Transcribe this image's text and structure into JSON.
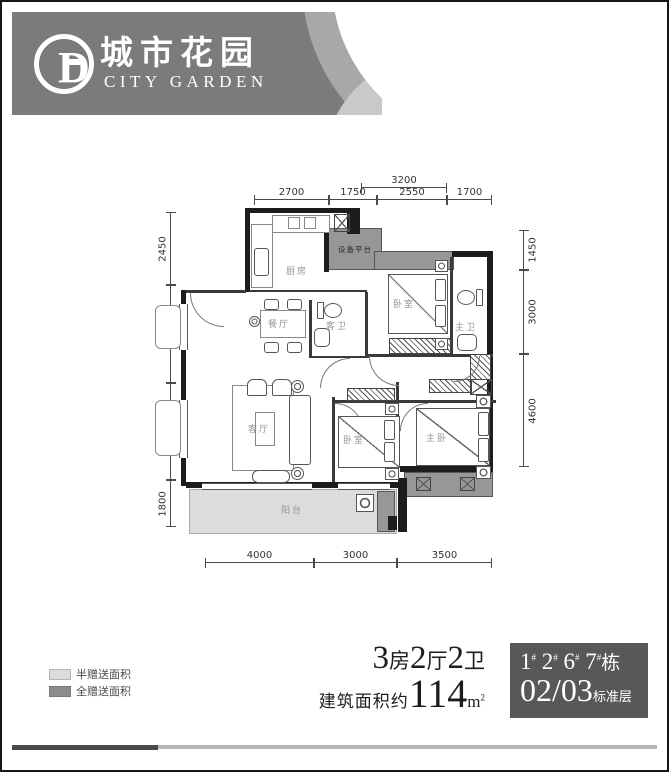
{
  "logo": {
    "letter_d": "D",
    "brand_cn": "城市花园",
    "brand_en": "CITY GARDEN"
  },
  "plan": {
    "rooms": {
      "kitchen": "厨房",
      "equipment": "设备平台",
      "bedroom_top": "卧室",
      "master_bath": "主卫",
      "dining": "餐厅",
      "guest_bath": "客卫",
      "living": "客厅",
      "bedroom_mid": "卧室",
      "master_bedroom": "主卧",
      "balcony": "阳台"
    },
    "dims": {
      "top_overall": "3200",
      "top": [
        "2700",
        "1750",
        "2550",
        "1700"
      ],
      "left": [
        "2450",
        "3800",
        "3300",
        "1800"
      ],
      "right": [
        "1450",
        "3000",
        "4600"
      ],
      "bottom": [
        "4000",
        "3000",
        "3500"
      ]
    }
  },
  "legend": {
    "items": [
      {
        "label": "半赠送面积",
        "color": "#dcdcde"
      },
      {
        "label": "全赠送面积",
        "color": "#8b8b8e"
      }
    ]
  },
  "summary": {
    "layout_digits": [
      "3",
      "2",
      "2"
    ],
    "layout_units": [
      "房",
      "厅",
      "卫"
    ],
    "area_prefix": "建筑面积约",
    "area_value": "114",
    "area_unit": "m",
    "area_sup": "2"
  },
  "badge": {
    "nums": [
      "1",
      "2",
      "6",
      "7"
    ],
    "hash": "#",
    "building_suffix": "栋",
    "floor": "02/03",
    "floor_suffix": "标准层"
  },
  "colors": {
    "banner": "#7b7b7e",
    "banner_light": "#a8a8ab",
    "banner_lighter": "#c9c9cc",
    "half_gift": "#dcdcde",
    "full_gift": "#97979a",
    "badge_bg": "#58585b",
    "bar_dark": "#4a4a4c",
    "bar_light": "#b5b5b7"
  }
}
